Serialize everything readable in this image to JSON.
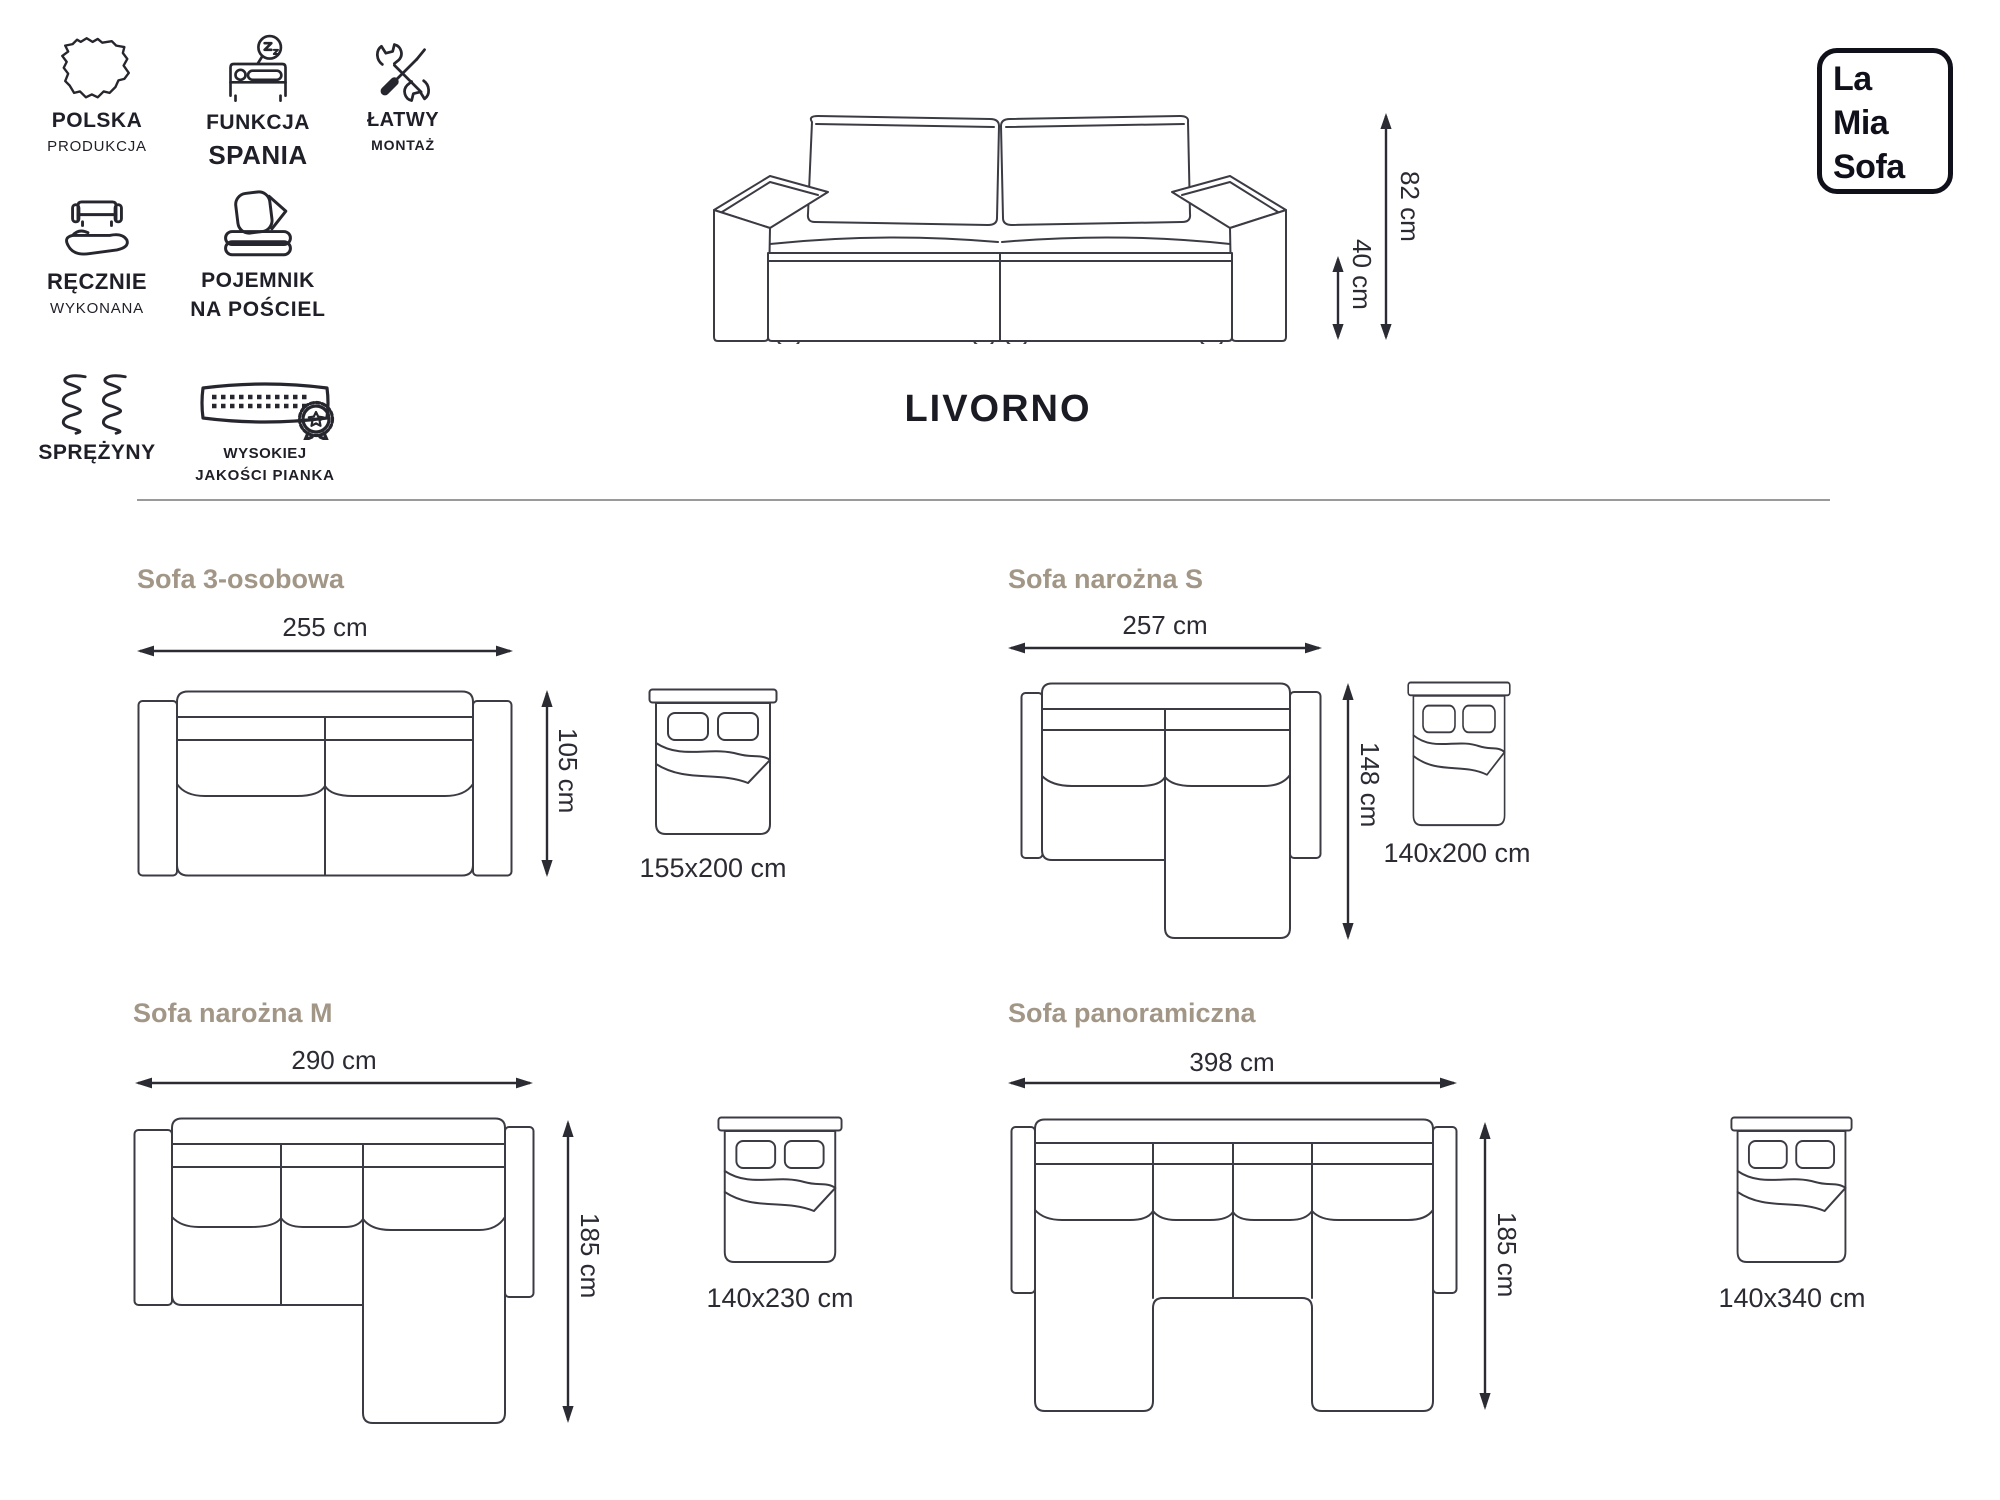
{
  "brand": {
    "line1": "La",
    "line2": "Mia",
    "line3": "Sofa"
  },
  "product": {
    "title": "LIVORNO",
    "height": "82 cm",
    "seat_height": "40 cm"
  },
  "features": [
    {
      "id": "polska-produkcja",
      "line1": "POLSKA",
      "line2": "PRODUKCJA",
      "icon": "poland-map-icon"
    },
    {
      "id": "funkcja-spania",
      "line1": "FUNKCJA",
      "line2": "SPANIA",
      "icon": "sleep-function-icon"
    },
    {
      "id": "latwy-montaz",
      "line1": "ŁATWY",
      "line2": "MONTAŻ",
      "icon": "tools-icon"
    },
    {
      "id": "recznie-wykonana",
      "line1": "RĘCZNIE",
      "line2": "WYKONANA",
      "icon": "hand-sofa-icon"
    },
    {
      "id": "pojemnik-na-posciel",
      "line1": "POJEMNIK",
      "line2": "NA POŚCIEL",
      "icon": "bedding-storage-icon"
    },
    {
      "id": "sprezyny",
      "line1": "SPRĘŻYNY",
      "line2": "",
      "icon": "springs-icon"
    },
    {
      "id": "wysokiej-jakosci-pianka",
      "line1": "WYSOKIEJ",
      "line2": "JAKOŚCI PIANKA",
      "icon": "foam-quality-icon"
    }
  ],
  "variants": [
    {
      "name": "Sofa 3-osobowa",
      "width": "255 cm",
      "depth": "105 cm",
      "bed": "155x200 cm",
      "type": "straight"
    },
    {
      "name": "Sofa narożna S",
      "width": "257 cm",
      "depth": "148 cm",
      "bed": "140x200 cm",
      "type": "corner"
    },
    {
      "name": "Sofa narożna M",
      "width": "290 cm",
      "depth": "185 cm",
      "bed": "140x230 cm",
      "type": "corner"
    },
    {
      "name": "Sofa panoramiczna",
      "width": "398 cm",
      "depth": "185 cm",
      "bed": "140x340 cm",
      "type": "panoramic"
    }
  ],
  "colors": {
    "ink": "#1f1f28",
    "heading": "#a29687",
    "line": "#3b3b44",
    "divider": "#9a9a9a"
  }
}
